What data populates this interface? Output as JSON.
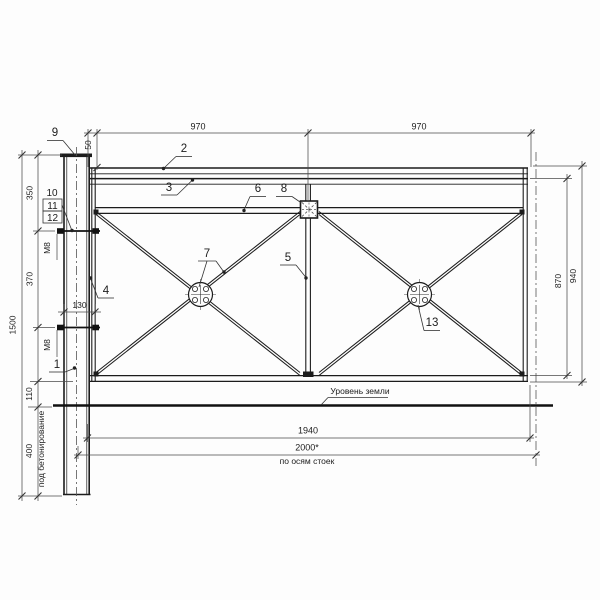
{
  "drawing": {
    "dims": {
      "span1": "970",
      "span2": "970",
      "offset50": "50",
      "v350": "350",
      "v370": "370",
      "v110": "110",
      "v400": "400",
      "v1500": "1500",
      "bolt130": "130",
      "h870": "870",
      "h940": "940",
      "w1940": "1940",
      "w2000": "2000*"
    },
    "notes": {
      "axes_note": "по осям стоек",
      "ground_level": "Уровень земли",
      "concrete_note": "под бетонирование",
      "bolt_label_1": "М8",
      "bolt_label_2": "М8"
    },
    "callouts": {
      "p1": "1",
      "p2": "2",
      "p3": "3",
      "p4": "4",
      "p5": "5",
      "p6": "6",
      "p7": "7",
      "p8": "8",
      "p9": "9",
      "p10": "10",
      "p11": "11",
      "p12": "12",
      "p13": "13"
    },
    "colors": {
      "line_main": "#1c1c1c",
      "line_dim": "#4a4a4a",
      "background": "#fdfdfd"
    }
  }
}
